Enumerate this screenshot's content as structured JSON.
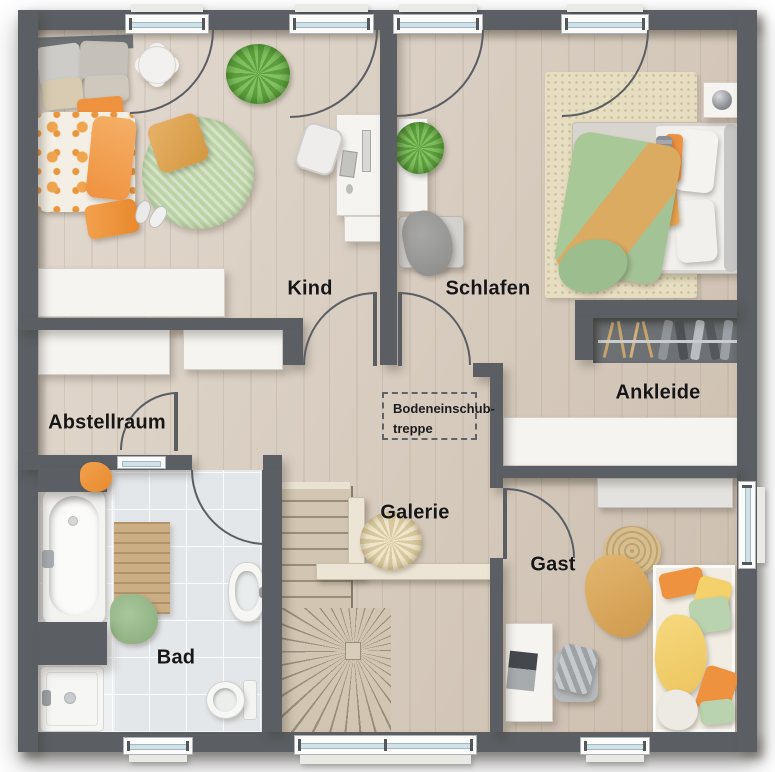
{
  "floorplan": {
    "rooms": [
      {
        "id": "kind",
        "label": "Kind"
      },
      {
        "id": "schlafen",
        "label": "Schlafen"
      },
      {
        "id": "ankleide",
        "label": "Ankleide"
      },
      {
        "id": "abstellraum",
        "label": "Abstellraum"
      },
      {
        "id": "bad",
        "label": "Bad"
      },
      {
        "id": "galerie",
        "label": "Galerie"
      },
      {
        "id": "gast",
        "label": "Gast"
      }
    ],
    "attic_note": {
      "line1": "Bodeneinschub-",
      "line2": "treppe"
    },
    "colors": {
      "wall": "#5b5f63",
      "floor-wood": "#d6c9ba",
      "floor-tile": "#e4e7ea",
      "furniture-white": "#f5f4f1",
      "window-glass": "#cfe2ea",
      "accent-orange": "#ef9240",
      "accent-green": "#a9c897",
      "accent-ochre": "#dcab62",
      "rug-green": "#bcd3a6",
      "rug-beige": "#e7ddc0",
      "closet-dark": "#6d7174",
      "stair-wood": "#d2c5b2"
    }
  }
}
